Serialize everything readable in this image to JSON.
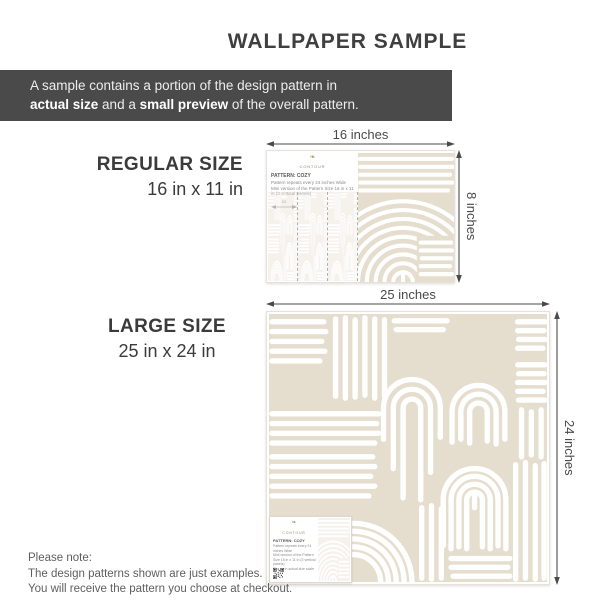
{
  "title": "WALLPAPER SAMPLE",
  "banner": {
    "line1": "A sample contains a portion of the design pattern in",
    "line2_bold1": "actual size",
    "line2_mid": " and a ",
    "line2_bold2": "small preview",
    "line2_end": " of the overall pattern."
  },
  "regular": {
    "size_label": "REGULAR SIZE",
    "dimensions": "16 in x 11 in",
    "width_label": "16 inches",
    "height_label": "8 inches"
  },
  "large": {
    "size_label": "LARGE SIZE",
    "dimensions": "25 in x 24 in",
    "width_label": "25 inches",
    "height_label": "24 inches"
  },
  "sample_card": {
    "brand": "CONTOUR",
    "pattern_name": "PATTERN: COZY",
    "info_line1": "Pattern repeats every 24 inches Wide",
    "info_line2": "Mini version of the Pattern Size 16 in x 11 in (3 vertical panels)",
    "info_line3": "Shown in actual size scale",
    "repeat_label": "24",
    "logo_glyph": "❧"
  },
  "footer": {
    "line1": "Please note:",
    "line2": "The design patterns shown are just examples.",
    "line3": "You will receive the pattern you choose at checkout."
  },
  "icons": {
    "qr_code": "qr-code",
    "brand_logo": "floral-brand-mark",
    "dimension_arrows": "double-headed-arrow"
  },
  "colors": {
    "banner_bg": "#4a4a4a",
    "pattern_beige": "#e5ddcd",
    "accent_gold": "#b09a6a",
    "text_dark": "#3d3d3d"
  }
}
